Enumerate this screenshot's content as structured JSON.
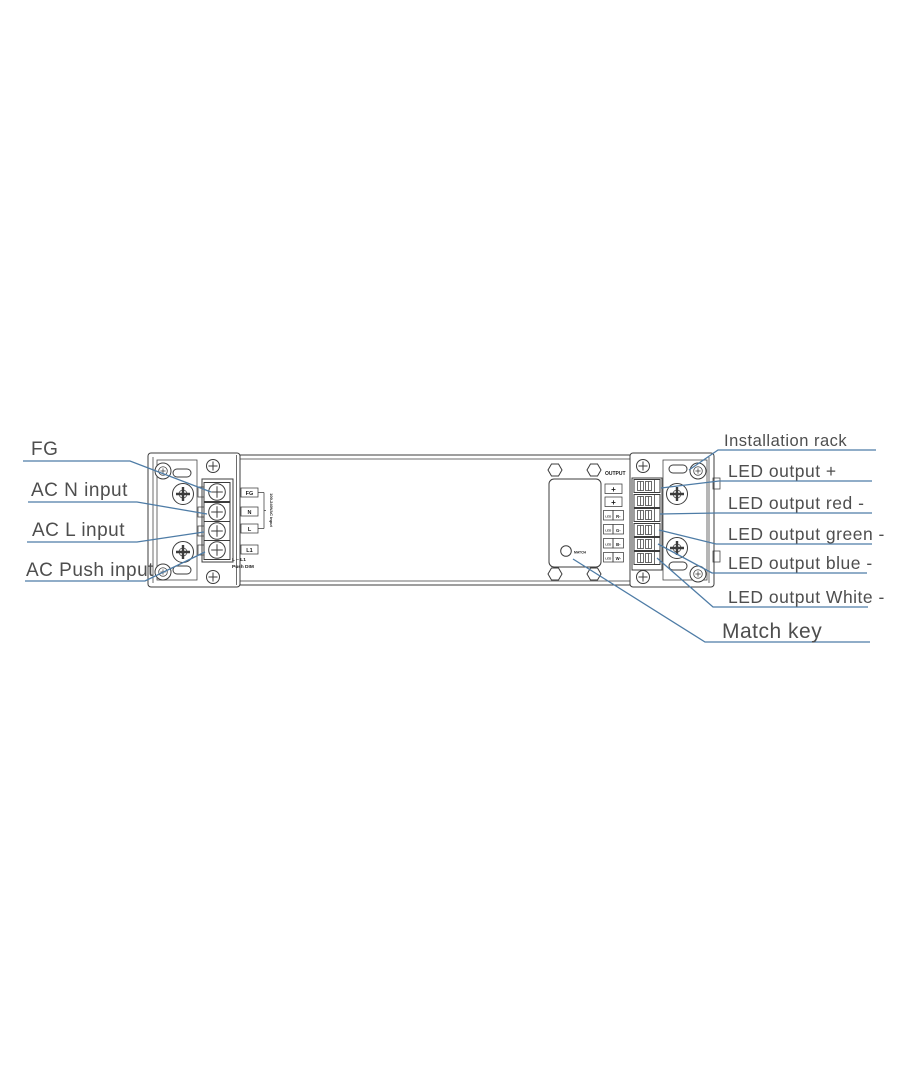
{
  "title": "LED dimmable driver terminal diagram",
  "colors": {
    "callout_line": "#4e7ca6",
    "label_text": "#4e4e4e",
    "device_line": "#3c3c3c",
    "background": "#ffffff"
  },
  "left_callouts": {
    "fg": "FG",
    "ac_n": "AC N input",
    "ac_l": "AC L input",
    "ac_push": "AC Push input"
  },
  "right_callouts": {
    "installation_rack": "Installation rack",
    "led_plus": "LED output +",
    "led_red": "LED output red -",
    "led_green": "LED output green -",
    "led_blue": "LED output blue -",
    "led_white": "LED output White -",
    "match_key": "Match key"
  },
  "device": {
    "input_terminal_labels": [
      "FG",
      "N",
      "L",
      "L1"
    ],
    "input_note_vertical": "100-240VAC input",
    "dim_note_line1": "L ~ L1",
    "dim_note_line2": "Push DIM",
    "output_header": "OUTPUT",
    "output_plus_boxes": [
      "+",
      "+"
    ],
    "output_channel_boxes": [
      [
        "LED",
        "R-"
      ],
      [
        "LED",
        "G-"
      ],
      [
        "LED",
        "B-"
      ],
      [
        "LED",
        "W-"
      ]
    ],
    "match_button_label": "MATCH"
  }
}
